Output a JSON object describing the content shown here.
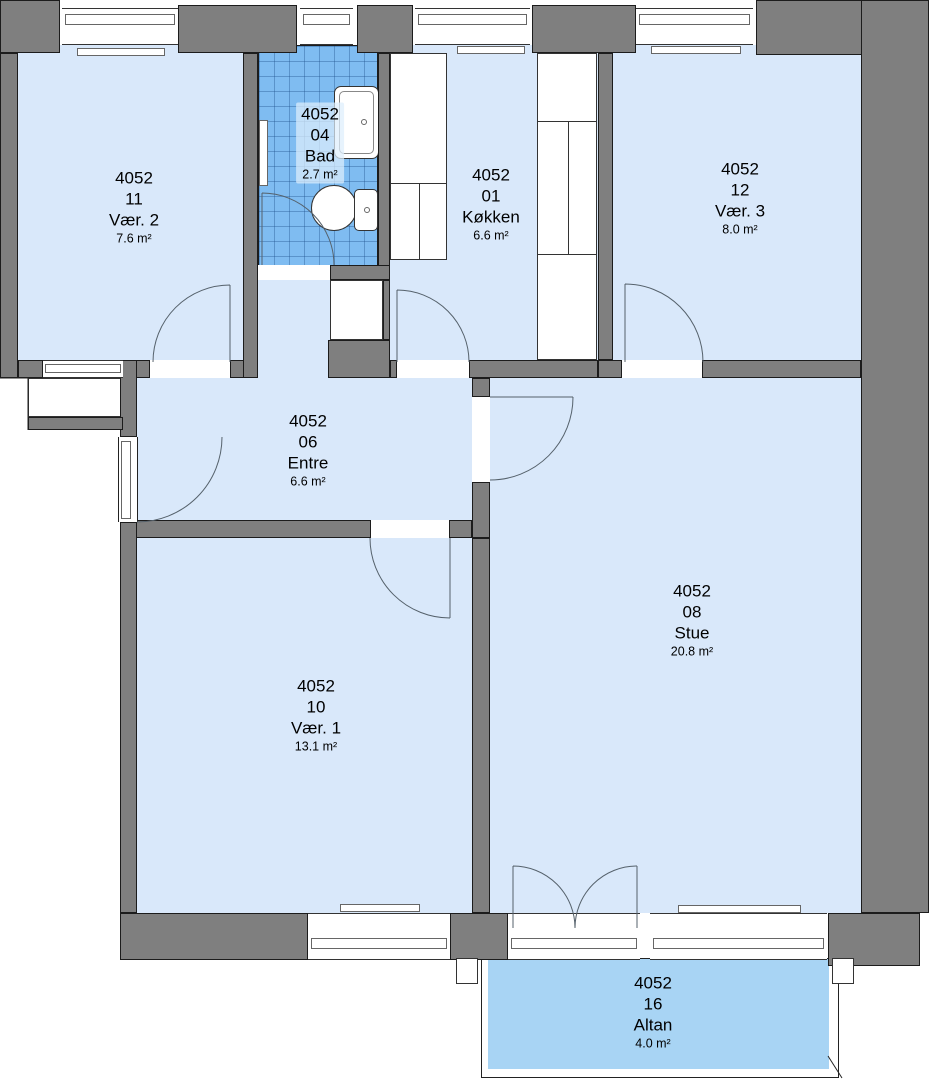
{
  "plan": {
    "unit_id": "4052"
  },
  "colors": {
    "wall": "#7f7f7f",
    "floor": "#d9e8fa",
    "wet_room": "#7fbcf1",
    "balcony": "#a8d4f4"
  },
  "rooms": [
    {
      "unit": "4052",
      "number": "11",
      "name": "Vær. 2",
      "area": "7.6 m²"
    },
    {
      "unit": "4052",
      "number": "04",
      "name": "Bad",
      "area": "2.7 m²"
    },
    {
      "unit": "4052",
      "number": "01",
      "name": "Køkken",
      "area": "6.6 m²"
    },
    {
      "unit": "4052",
      "number": "12",
      "name": "Vær. 3",
      "area": "8.0 m²"
    },
    {
      "unit": "4052",
      "number": "06",
      "name": "Entre",
      "area": "6.6 m²"
    },
    {
      "unit": "4052",
      "number": "08",
      "name": "Stue",
      "area": "20.8 m²"
    },
    {
      "unit": "4052",
      "number": "10",
      "name": "Vær. 1",
      "area": "13.1 m²"
    },
    {
      "unit": "4052",
      "number": "16",
      "name": "Altan",
      "area": "4.0 m²"
    }
  ]
}
